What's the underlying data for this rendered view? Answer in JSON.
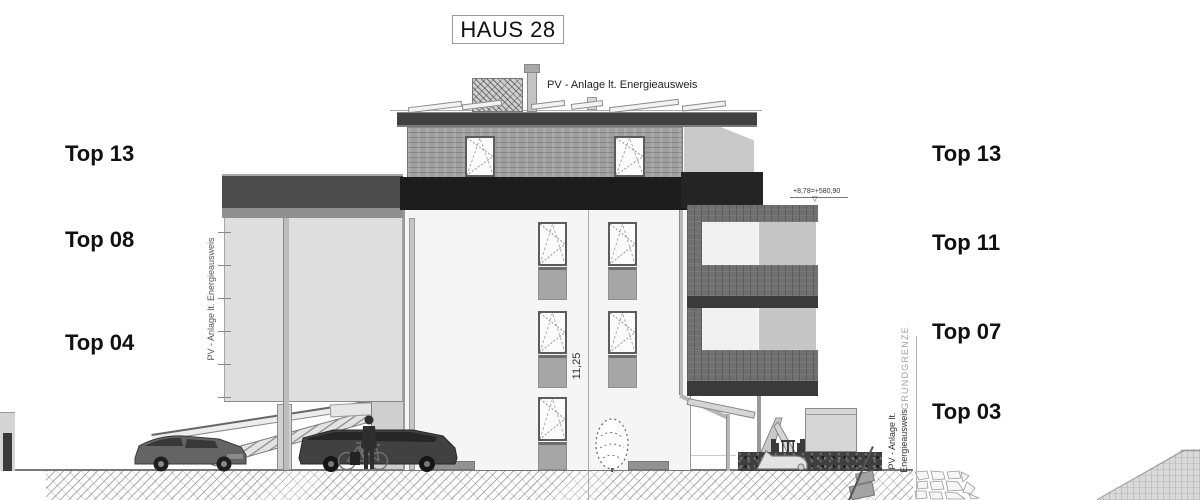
{
  "title": "HAUS 28",
  "roof_note": "PV - Anlage lt. Energieausweis",
  "left_labels": [
    {
      "label": "Top 13"
    },
    {
      "label": "Top 08"
    },
    {
      "label": "Top 04"
    }
  ],
  "right_labels": [
    {
      "label": "Top 13"
    },
    {
      "label": "Top 11"
    },
    {
      "label": "Top 07"
    },
    {
      "label": "Top 03"
    }
  ],
  "annotations": {
    "left_wall_pv_note": "PV - Anlage lt. Energieausweis",
    "boundary_label": "GRUNDGRENZE",
    "right_pv_note_line1": "PV - Anlage lt.",
    "right_pv_note_line2": "Energieausweis",
    "height_dimension": "11,25",
    "elevation_mark": "+8,78=+580,90",
    "elevation_marker_glyph": "▽"
  },
  "colors": {
    "ink": "#1c1c1c",
    "dark_band": "#1c1c1c",
    "mid_gray": "#707070",
    "wing_gray": "#4b4b4b",
    "facade": "#f5f5f5",
    "light_wall": "#dedede"
  }
}
